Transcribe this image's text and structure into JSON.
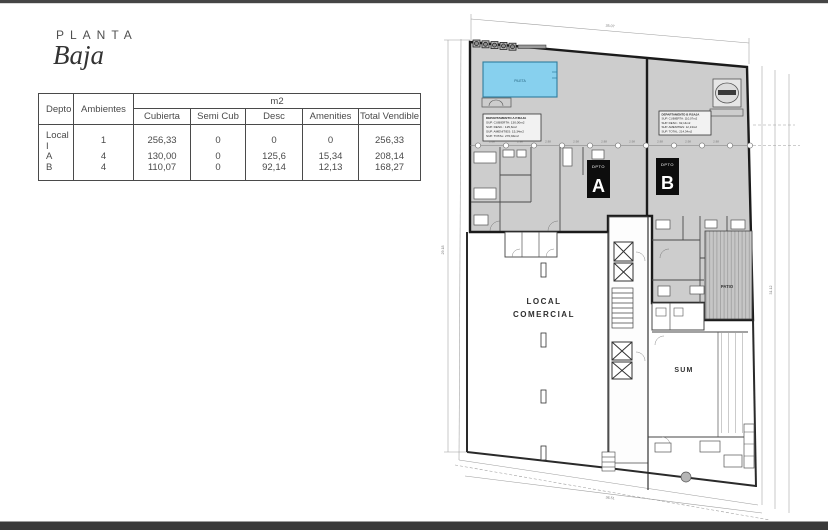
{
  "page": {
    "kicker": "PLANTA",
    "title": "Baja"
  },
  "table": {
    "m2_header": "m2",
    "col_depto": "Depto",
    "col_ambientes": "Ambientes",
    "col_cubierta": "Cubierta",
    "col_semicub": "Semi Cub",
    "col_desc": "Desc",
    "col_amenities": "Amenities",
    "col_total": "Total Vendible",
    "rows": [
      {
        "depto": "Local I",
        "ambientes": "1",
        "cubierta": "256,33",
        "semicub": "0",
        "desc": "0",
        "amenities": "0",
        "total": "256,33"
      },
      {
        "depto": "A",
        "ambientes": "4",
        "cubierta": "130,00",
        "semicub": "0",
        "desc": "125,6",
        "amenities": "15,34",
        "total": "208,14"
      },
      {
        "depto": "B",
        "ambientes": "4",
        "cubierta": "110,07",
        "semicub": "0",
        "desc": "92,14",
        "amenities": "12,13",
        "total": "168,27"
      }
    ]
  },
  "plan": {
    "labels": {
      "pool": "PILETA",
      "local_line1": "LOCAL",
      "local_line2": "COMERCIAL",
      "sum": "SUM",
      "patio": "PATIO",
      "dpto": "DPTO",
      "unit_a": "A",
      "unit_b": "B"
    },
    "info_a": [
      "DEPARTAMENTO A  P.BAJA",
      "SUP. CUBIERTA: 130,00m2",
      "SUP. DESC.: 125,6m2",
      "SUP. AMENITIES: 15,34m2",
      "SUP. TOTAL: 270,94m2"
    ],
    "info_b": [
      "DEPARTAMENTO B  P.BAJA",
      "SUP. CUBIERTA: 110,07m2",
      "SUP. DESC.: 92,14m2",
      "SUP. AMENITIES: 12,13m2",
      "SUP. TOTAL: 214,34m2"
    ],
    "dims": {
      "top": "35.07",
      "bottom": "36.51",
      "left": "29.18",
      "right": "31.12",
      "bays": [
        "2.88",
        "2.98",
        "2.88",
        "2.98",
        "2.88",
        "2.98",
        "2.88",
        "2.98",
        "2.88"
      ]
    },
    "colors": {
      "pool_fill": "#87d0ee",
      "zone_fill": "#cdcdcd",
      "wall": "#1b1b1b"
    }
  }
}
